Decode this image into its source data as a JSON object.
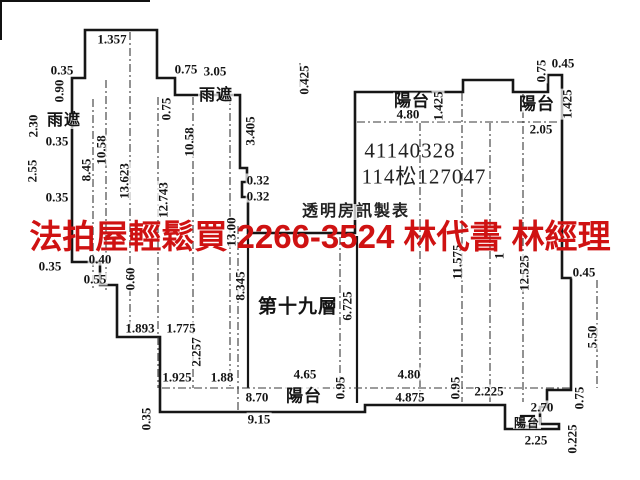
{
  "document": {
    "kind": "floor-plan-diagram",
    "floor_label": "第十九層",
    "maker_caption": "透明房訊製表",
    "property_ids": [
      "41140328",
      "114松127047"
    ]
  },
  "watermark": {
    "text": "法拍屋輕鬆買  2266-3524  林代書 林經理",
    "color": "#cf1212"
  },
  "colors": {
    "background": "#ffffff",
    "line": "#161616",
    "text": "#141414"
  },
  "plan": {
    "labels": [
      {
        "t": "1.357",
        "x": 112,
        "y": 39
      },
      {
        "t": "0.35",
        "x": 62,
        "y": 70
      },
      {
        "t": "0.90",
        "x": 59,
        "y": 91,
        "r": 1
      },
      {
        "t": "0.75",
        "x": 186,
        "y": 69
      },
      {
        "t": "3.05",
        "x": 215,
        "y": 71
      },
      {
        "t": "雨遮",
        "x": 216,
        "y": 96,
        "s": 16,
        "k": "room"
      },
      {
        "t": "0.425",
        "x": 304,
        "y": 80,
        "r": 1
      },
      {
        "t": "0.75",
        "x": 166,
        "y": 109,
        "r": 1
      },
      {
        "t": "雨遮",
        "x": 64,
        "y": 121,
        "s": 16,
        "k": "room"
      },
      {
        "t": "2.30",
        "x": 33,
        "y": 126,
        "r": 1
      },
      {
        "t": "0.35",
        "x": 57,
        "y": 141
      },
      {
        "t": "2.55",
        "x": 32,
        "y": 171,
        "r": 1
      },
      {
        "t": "8.45",
        "x": 86,
        "y": 170,
        "r": 1
      },
      {
        "t": "10.58",
        "x": 101,
        "y": 150,
        "r": 1
      },
      {
        "t": "13.623",
        "x": 124,
        "y": 181,
        "r": 1
      },
      {
        "t": "0.35",
        "x": 57,
        "y": 197
      },
      {
        "t": "10.58",
        "x": 189,
        "y": 142,
        "r": 1
      },
      {
        "t": "12.743",
        "x": 163,
        "y": 200,
        "r": 1
      },
      {
        "t": "3.405",
        "x": 250,
        "y": 131,
        "r": 1
      },
      {
        "t": "0.32",
        "x": 258,
        "y": 180
      },
      {
        "t": "0.32",
        "x": 258,
        "y": 196
      },
      {
        "t": "13.00",
        "x": 231,
        "y": 232,
        "r": 1
      },
      {
        "t": "0.40",
        "x": 100,
        "y": 259
      },
      {
        "t": "0.35",
        "x": 50,
        "y": 266
      },
      {
        "t": "0.55",
        "x": 95,
        "y": 279
      },
      {
        "t": "0.60",
        "x": 130,
        "y": 279,
        "r": 1
      },
      {
        "t": "1.893",
        "x": 140,
        "y": 328
      },
      {
        "t": "1.775",
        "x": 181,
        "y": 328
      },
      {
        "t": "2.257",
        "x": 196,
        "y": 352,
        "r": 1
      },
      {
        "t": "1.925",
        "x": 177,
        "y": 377
      },
      {
        "t": "1.88",
        "x": 222,
        "y": 377
      },
      {
        "t": "0.35",
        "x": 146,
        "y": 419,
        "r": 1
      },
      {
        "t": "8.70",
        "x": 257,
        "y": 397
      },
      {
        "t": "9.15",
        "x": 259,
        "y": 419
      },
      {
        "t": "陽台",
        "x": 304,
        "y": 396,
        "s": 17,
        "k": "room"
      },
      {
        "t": "4.65",
        "x": 305,
        "y": 374
      },
      {
        "t": "0.95",
        "x": 340,
        "y": 388,
        "r": 1
      },
      {
        "t": "8.345",
        "x": 240,
        "y": 286,
        "r": 1
      },
      {
        "t": "第十九層",
        "x": 298,
        "y": 307,
        "s": 19,
        "k": "room"
      },
      {
        "t": "6.725",
        "x": 347,
        "y": 306,
        "r": 1
      },
      {
        "t": "透明房訊製表",
        "x": 356,
        "y": 212,
        "s": 16,
        "k": "caption"
      },
      {
        "t": "41140328",
        "x": 410,
        "y": 151,
        "s": 21,
        "k": "id"
      },
      {
        "t": "114松127047",
        "x": 424,
        "y": 177,
        "s": 21,
        "k": "id"
      },
      {
        "t": "陽台",
        "x": 412,
        "y": 101,
        "s": 17,
        "k": "room"
      },
      {
        "t": "4.80",
        "x": 408,
        "y": 114
      },
      {
        "t": "1.425",
        "x": 438,
        "y": 106,
        "r": 1
      },
      {
        "t": "陽台",
        "x": 537,
        "y": 104,
        "s": 17,
        "k": "room"
      },
      {
        "t": "2.05",
        "x": 541,
        "y": 129
      },
      {
        "t": "1.425",
        "x": 567,
        "y": 104,
        "r": 1
      },
      {
        "t": "0.75",
        "x": 541,
        "y": 71,
        "r": 1
      },
      {
        "t": "0.45",
        "x": 563,
        "y": 63
      },
      {
        "t": "11.575",
        "x": 457,
        "y": 262,
        "r": 1
      },
      {
        "t": "1",
        "x": 499,
        "y": 256,
        "r": 1
      },
      {
        "t": "12.525",
        "x": 524,
        "y": 273,
        "r": 1
      },
      {
        "t": "4.80",
        "x": 409,
        "y": 374
      },
      {
        "t": "4.875",
        "x": 410,
        "y": 397
      },
      {
        "t": "0.95",
        "x": 455,
        "y": 388,
        "r": 1
      },
      {
        "t": "2.225",
        "x": 489,
        "y": 391
      },
      {
        "t": "2.70",
        "x": 542,
        "y": 407
      },
      {
        "t": "陽台",
        "x": 527,
        "y": 423,
        "s": 12,
        "k": "room"
      },
      {
        "t": "2.25",
        "x": 536,
        "y": 440
      },
      {
        "t": "0.225",
        "x": 572,
        "y": 439,
        "r": 1
      },
      {
        "t": "0.75",
        "x": 579,
        "y": 398,
        "r": 1
      },
      {
        "t": "5.50",
        "x": 592,
        "y": 337,
        "r": 1
      },
      {
        "t": "0.45",
        "x": 584,
        "y": 272
      }
    ]
  }
}
